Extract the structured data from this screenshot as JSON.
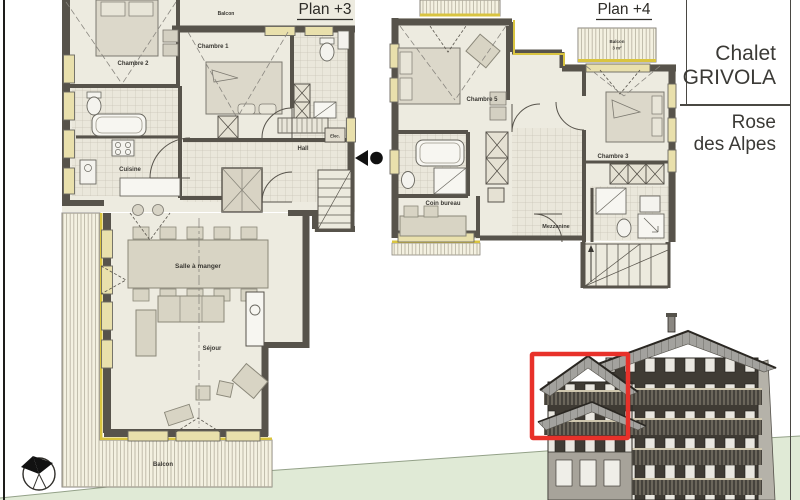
{
  "title_block": {
    "chalet_line1": "Chalet",
    "chalet_line2": "GRIVOLA",
    "residence_line1": "Rose",
    "residence_line2": "des Alpes"
  },
  "plan3": {
    "title": "Plan +3",
    "labels": {
      "chambre2": "Chambre 2",
      "chambre1": "Chambre 1",
      "cuisine": "Cuisine",
      "hall": "Hall",
      "elec": "Elec.",
      "balcon_top": "Balcon",
      "salle_a_manger": "Salle à manger",
      "sejour": "Séjour",
      "balcon": "Balcon"
    }
  },
  "plan4": {
    "title": "Plan +4",
    "labels": {
      "chambre5": "Chambre 5",
      "chambre3": "Chambre 3",
      "coin_bureau": "Coin bureau",
      "mezzanine": "Mezzanine",
      "balcon_line1": "Balcon",
      "balcon_line2": "3 m²"
    }
  },
  "colors": {
    "highlight_red": "#e8312a",
    "terrain_green": "#e0ead6",
    "balcony_fill": "#f4f1e1",
    "window_yellow": "#e9e0ac",
    "accent_yellow": "#d9c440",
    "wall_gray": "#57534b",
    "roof_gray": "#a3a29e",
    "facade_dark": "#3f3b34"
  }
}
